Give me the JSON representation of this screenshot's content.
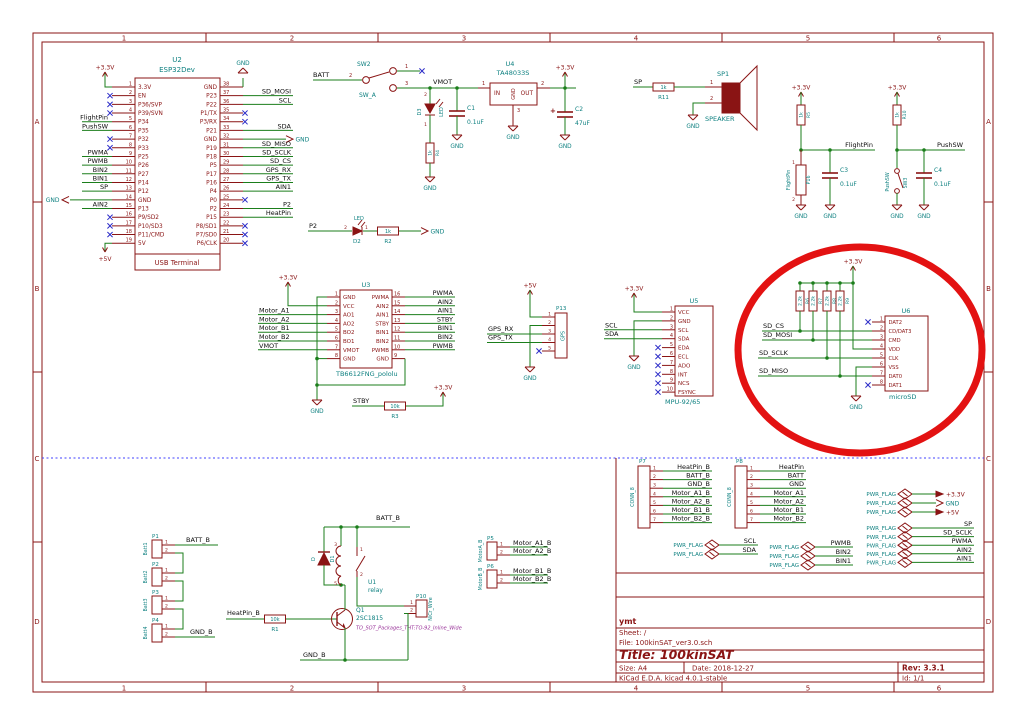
{
  "colors": {
    "wire": "#1b7e1b",
    "symbol": "#8a1414",
    "ref_text": "#0e8080",
    "net_text": "#0b0b0b",
    "noconnect": "#2c2cc8",
    "footprint_text": "#993399",
    "separator": "#4040ff",
    "annotation": "#e31212",
    "paper": "#ffffff"
  },
  "frame": {
    "columns": [
      "1",
      "2",
      "3",
      "4",
      "5",
      "6"
    ],
    "rows": [
      "A",
      "B",
      "C",
      "D"
    ]
  },
  "title_block": {
    "author": "ymt",
    "sheet": "Sheet: /",
    "file": "File: 100kinSAT_ver3.0.sch",
    "title": "Title: 100kinSAT",
    "size": "Size: A4",
    "date": "Date: 2018-12-27",
    "rev": "Rev: 3.3.1",
    "tool": "KiCad E.D.A.  kicad 4.0.1-stable",
    "id": "Id: 1/1"
  },
  "power": {
    "v33": "+3.3V",
    "v5": "+5V",
    "gnd": "GND",
    "flag": "PWR_FLAG"
  },
  "u2": {
    "ref": "U2",
    "value": "ESP32Dev",
    "sub": "USB Terminal",
    "left": [
      [
        "1",
        "3.3V",
        "p33"
      ],
      [
        "2",
        "EN",
        "nc"
      ],
      [
        "3",
        "P36/SVP",
        "nc"
      ],
      [
        "4",
        "P39/SVN",
        "nc"
      ],
      [
        "5",
        "P34",
        "FlightPin"
      ],
      [
        "6",
        "P35",
        "PushSW"
      ],
      [
        "7",
        "P32",
        "nc"
      ],
      [
        "8",
        "P33",
        "nc"
      ],
      [
        "9",
        "P25",
        "PWMA"
      ],
      [
        "10",
        "P26",
        "PWMB"
      ],
      [
        "11",
        "P27",
        "BIN2"
      ],
      [
        "12",
        "P14",
        "BIN1"
      ],
      [
        "13",
        "P12",
        "SP"
      ],
      [
        "14",
        "GND",
        "gndl"
      ],
      [
        "15",
        "P13",
        "AIN2"
      ],
      [
        "16",
        "P9/SD2",
        "nc"
      ],
      [
        "17",
        "P10/SD3",
        "nc"
      ],
      [
        "18",
        "P11/CMD",
        "nc"
      ],
      [
        "19",
        "5V",
        "p5"
      ]
    ],
    "right": [
      [
        "38",
        "GND",
        "gndu"
      ],
      [
        "37",
        "P23",
        "SD_MOSI"
      ],
      [
        "36",
        "P22",
        "SCL"
      ],
      [
        "35",
        "P1/TX",
        "nc"
      ],
      [
        "34",
        "P3/RX",
        "nc"
      ],
      [
        "33",
        "P21",
        "SDA"
      ],
      [
        "32",
        "GND",
        "gndr"
      ],
      [
        "31",
        "P19",
        "SD_MISO"
      ],
      [
        "30",
        "P18",
        "SD_SCLK"
      ],
      [
        "29",
        "P5",
        "SD_CS"
      ],
      [
        "28",
        "P17",
        "GPS_RX"
      ],
      [
        "27",
        "P16",
        "GPS_TX"
      ],
      [
        "26",
        "P4",
        "AIN1"
      ],
      [
        "25",
        "P0",
        "nc"
      ],
      [
        "24",
        "P2",
        "P2"
      ],
      [
        "23",
        "P15",
        "HeatPin"
      ],
      [
        "22",
        "P8/SD1",
        "nc"
      ],
      [
        "21",
        "P7/SD0",
        "nc"
      ],
      [
        "20",
        "P6/CLK",
        "nc"
      ]
    ]
  },
  "u3": {
    "ref": "U3",
    "value": "TB6612FNG_pololu",
    "left": [
      [
        "1",
        "GND",
        "w"
      ],
      [
        "2",
        "VCC",
        "w"
      ],
      [
        "3",
        "AO1",
        "Motor_A1"
      ],
      [
        "4",
        "AO2",
        "Motor_A2"
      ],
      [
        "5",
        "BO2",
        "Motor_B1"
      ],
      [
        "6",
        "BO1",
        "Motor_B2"
      ],
      [
        "7",
        "VMOT",
        "VMOT"
      ],
      [
        "8",
        "GND",
        "w"
      ]
    ],
    "right": [
      [
        "16",
        "PWMA",
        "PWMA"
      ],
      [
        "15",
        "AIN2",
        "AIN2"
      ],
      [
        "14",
        "AIN1",
        "AIN1"
      ],
      [
        "13",
        "STBY",
        "STBY"
      ],
      [
        "12",
        "BIN1",
        "BIN1"
      ],
      [
        "11",
        "BIN2",
        "BIN2"
      ],
      [
        "10",
        "PWMB",
        "PWMB"
      ],
      [
        "9",
        "GND",
        "w"
      ]
    ]
  },
  "u4": {
    "ref": "U4",
    "value": "TA48033S",
    "pin_in": "IN",
    "pin_gnd": "GND",
    "pin_out": "OUT",
    "n_in": "1",
    "n_gnd": "3",
    "n_out": "2"
  },
  "u5": {
    "ref": "U5",
    "value": "MPU-92/65",
    "pins": [
      [
        "1",
        "VCC",
        "pwr"
      ],
      [
        "2",
        "GND",
        "gnd"
      ],
      [
        "3",
        "SCL",
        "SCL"
      ],
      [
        "4",
        "SDA",
        "SDA"
      ],
      [
        "5",
        "EDA",
        "nc"
      ],
      [
        "6",
        "ECL",
        "nc"
      ],
      [
        "7",
        "ADO",
        "nc"
      ],
      [
        "8",
        "INT",
        "nc"
      ],
      [
        "9",
        "NCS",
        "nc"
      ],
      [
        "10",
        "FSYNC",
        "nc"
      ]
    ]
  },
  "u6": {
    "ref": "U6",
    "value": "microSD",
    "pins": [
      [
        "1",
        "DAT2",
        "nc"
      ],
      [
        "2",
        "CD/DAT3",
        "SD_CS"
      ],
      [
        "3",
        "CMD",
        "SD_MOSI"
      ],
      [
        "4",
        "VDD",
        "pwr"
      ],
      [
        "5",
        "CLK",
        "SD_SCLK"
      ],
      [
        "6",
        "VSS",
        "gnd"
      ],
      [
        "7",
        "DAT0",
        "SD_MISO"
      ],
      [
        "8",
        "DAT1",
        "nc"
      ]
    ]
  },
  "u1": {
    "ref": "U1",
    "value": "relay",
    "coil_pins": [
      "3",
      "5"
    ],
    "contact_pins": [
      "1",
      "2"
    ]
  },
  "q1": {
    "ref": "Q1",
    "value": "2SC1815",
    "footprint": "TO_SOT_Packages_THT:TO-92_Inline_Wide"
  },
  "d1": {
    "ref": "D1",
    "value": "D"
  },
  "d2": {
    "ref": "D2",
    "value": "LED",
    "pins": [
      "2",
      "1"
    ]
  },
  "d3": {
    "ref": "D3",
    "value": "LED",
    "pins": [
      "2",
      "1"
    ]
  },
  "sp1": {
    "ref": "SP1",
    "value": "SPEAKER",
    "pins": [
      "1",
      "2"
    ]
  },
  "sw2": {
    "ref": "SW2",
    "value": "SW_A",
    "pins": [
      "1",
      "2",
      "3"
    ]
  },
  "sw3": {
    "ref": "SW3",
    "value": "PushSW"
  },
  "resistors": {
    "r1": [
      "R1",
      "10k"
    ],
    "r2": [
      "R2",
      "1k"
    ],
    "r3": [
      "R3",
      "10k"
    ],
    "r4": [
      "R4",
      "1k"
    ],
    "r5": [
      "R5",
      "1k"
    ],
    "r6": [
      "R6",
      "2.2k"
    ],
    "r7": [
      "R7",
      "2.2k"
    ],
    "r8": [
      "R8",
      "2.2k"
    ],
    "r9": [
      "R9",
      "2.2k"
    ],
    "r10": [
      "R10",
      "1k"
    ],
    "r11": [
      "R11",
      "1k"
    ]
  },
  "capacitors": {
    "c1": [
      "C1",
      "0.1uF"
    ],
    "c2": [
      "C2",
      "47uF"
    ],
    "c3": [
      "C3",
      "0.1uF"
    ],
    "c4": [
      "C4",
      "0.1uF"
    ]
  },
  "nets": {
    "vmot": "VMOT",
    "batt": "BATT",
    "sp": "SP",
    "flightpin": "FlightPin",
    "pushsw": "PushSW",
    "stby": "STBY",
    "p2": "P2",
    "scl": "SCL",
    "sda": "SDA",
    "gps_rx": "GPS_RX",
    "gps_tx": "GPS_TX",
    "sd_cs": "SD_CS",
    "sd_mosi": "SD_MOSI",
    "sd_sclk": "SD_SCLK",
    "sd_miso": "SD_MISO",
    "batt_b": "BATT_B",
    "gnd_b": "GND_B",
    "heatpin_b": "HeatPin_B"
  },
  "batteries": {
    "refs": [
      "P1",
      "P2",
      "P3",
      "P4"
    ],
    "values": [
      "Batt1",
      "Batt2",
      "Batt3",
      "Batt4"
    ]
  },
  "p5": {
    "ref": "P5",
    "value": "MotorA_B",
    "labels": [
      "Motor_A1_B",
      "Motor_A2_B"
    ]
  },
  "p6": {
    "ref": "P6",
    "value": "MotorB_B",
    "labels": [
      "Motor_B1_B",
      "Motor_B2_B"
    ]
  },
  "p7": {
    "ref": "P7",
    "value": "CONN_8",
    "labels": [
      "HeatPin_B",
      "BATT_B",
      "GND_B",
      "Motor_A1_B",
      "Motor_A2_B",
      "Motor_B1_B",
      "Motor_B2_B"
    ]
  },
  "p8": {
    "ref": "P8",
    "value": "CONN_8",
    "labels": [
      "HeatPin",
      "BATT",
      "GND",
      "Motor_A1",
      "Motor_A2",
      "Motor_B1",
      "Motor_B2"
    ]
  },
  "p10": {
    "ref": "P10",
    "value": "NiCr_Wire",
    "pins": [
      "1",
      "2"
    ]
  },
  "p13": {
    "ref": "P13",
    "value": "GPS",
    "pins": [
      "1",
      "2",
      "3",
      "4",
      "5"
    ]
  },
  "p16": {
    "ref": "P16",
    "value": "FlightPin",
    "pins": [
      "1",
      "2"
    ]
  },
  "pwr_flags": {
    "i2c": [
      "SCL",
      "SDA"
    ],
    "motor": [
      "PWMB",
      "BIN2",
      "BIN1"
    ],
    "rails": [
      "+3.3V",
      "GND",
      "+5V"
    ],
    "signals": [
      "SP",
      "SD_SCLK",
      "PWMA",
      "AIN2",
      "AIN1"
    ]
  }
}
